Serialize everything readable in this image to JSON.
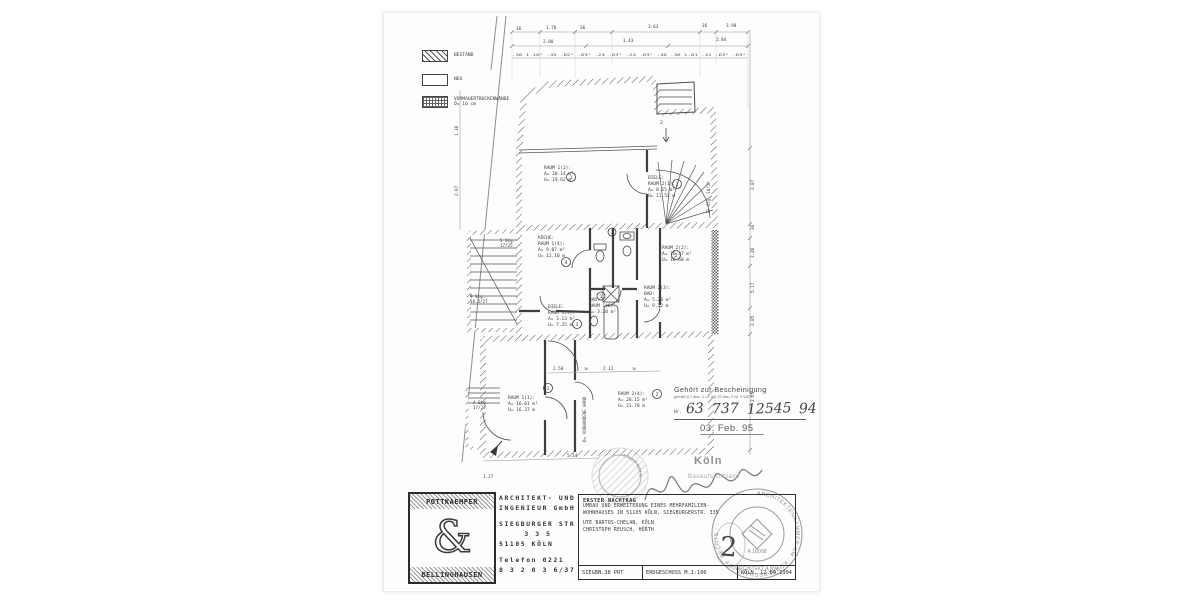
{
  "legend": {
    "bestand": "BESTAND",
    "neu": "NEU",
    "vormauer": "VORMAUERTROCKENWÄNDE",
    "vormauer_sub": "D= 16 cm"
  },
  "rooms": {
    "r12": {
      "l1": "RAUM 1(2):",
      "l2": "A= 20.14 m²",
      "l3": "U= 19.62 m"
    },
    "d21": {
      "l1": "DIELE:",
      "l2": "RAUM 2(1):",
      "l3": "A= 8.15 m²",
      "l4": "U= 11.52 m"
    },
    "kue": {
      "l1": "KÜCHE:",
      "l2": "RAUM 1(4):",
      "l3": "A= 9.07 m²",
      "l4": "U= 12.10 m"
    },
    "r22": {
      "l1": "RAUM 2(2):",
      "l2": "A= 16.37 m²",
      "l3": "U= 16.68 m"
    },
    "b23": {
      "l1": "RAUM 2(3):",
      "l2": "BAD:",
      "l3": "A= 5.28 m²",
      "l4": "U= 9.32 m"
    },
    "b16": {
      "l1": "BAD:",
      "l2": "RAUM 1(6):",
      "l3": "A= 3.20 m²"
    },
    "d15": {
      "l1": "DIELE:",
      "l2": "RAUM 1(5):",
      "l3": "A= 3.13 m²",
      "l4": "U= 7.25 m"
    },
    "r11": {
      "l1": "RAUM 1(1):",
      "l2": "A= 16.01 m²",
      "l3": "U= 16.37 m"
    },
    "r24": {
      "l1": "RAUM 2(4):",
      "l2": "A= 28.15 m²",
      "l3": "U= 21.78 m"
    }
  },
  "markers": {
    "m1": "1",
    "m2": "2",
    "m3": "4",
    "m4": "2",
    "m5": "2",
    "m6": "1",
    "m7": "3",
    "m8": "1",
    "m9": "2"
  },
  "stairs": {
    "s1a": "5 Stg.",
    "s1b": "17/25",
    "s2a": "9 Stg.",
    "s2b": "18.5/27",
    "s3a": "4 Stg.",
    "s3b": "17/27",
    "s4": "13 Stg. 18/25",
    "entry": "2"
  },
  "note": {
    "wall": "D= VORHANDENE WAND"
  },
  "dims": {
    "top1": [
      "36",
      "1.70",
      "36",
      "3.63",
      "36",
      "3.90"
    ],
    "top2": [
      "2.00",
      "3.43",
      "2.84"
    ],
    "micro": ".36 1.10⁵ .45 .82⁵ .63⁵ .24 .63⁵ .24 .63⁵ .40 .36 1.01 .41 .63⁵ .63⁵",
    "right": [
      "2.87",
      "36",
      "2.46",
      "5.17",
      "2.85",
      "2.65"
    ],
    "left": [
      "1.36",
      "2.07"
    ],
    "bottom": [
      "1.27",
      "5.14"
    ],
    "inner": [
      "2.50",
      "36",
      "2.12",
      "36"
    ]
  },
  "approval": {
    "title": "Gehört zur Bescheinigung",
    "legal": "gemäß § 7 Abs. 4 i.V. 2/§ 32 Abs. 2 Nr. 2 WEG",
    "nr": "Nr.",
    "numbers": [
      "63",
      "737",
      "12545",
      "94"
    ],
    "date": "03. Feb. 95"
  },
  "city": {
    "name": "Köln",
    "office": "Bauaufsichtsamt",
    "seal": "· STADT KÖLN ·"
  },
  "tb": {
    "logo_top": "POTTKAEMPER",
    "amp": "&",
    "logo_bottom": "BELLINGHAUSEN",
    "firm1": "ARCHITEKT- UND",
    "firm2": "INGENIEUR GmbH",
    "addr1": "SIEGBURGER STR",
    "addr2": "3 3 5",
    "addr3": "51105 KÖLN",
    "tel1": "Telefon 0221",
    "tel2": "8 3 2 0 3 6/37",
    "p1": "ERSTER NACHTRAG",
    "p2": "UMBAU UND ERWEITERUNG EINES MEHRFAMILIEN-",
    "p3": "WOHNHAUSES IN 51105 KÖLN, SIEGBURGERSTR. 335",
    "p4": "UTE BARTOS-CHELAN, KÖLN",
    "p5": "CHRISTOPH REUSCH, HÜRTH",
    "big_no": "2",
    "f1": "SIEGBN.38 PRT",
    "f2": "ERDGESCHOSS M.1:100",
    "f3": "KÖLN, 12.09.1994"
  },
  "chamber": {
    "ring": "ARCHITEKTENKAMMER NW · KÖRPERSCHAFT ÖFF. RECHTS ·",
    "type": "ARCHITEKT A NW",
    "reg": "A 18008"
  }
}
